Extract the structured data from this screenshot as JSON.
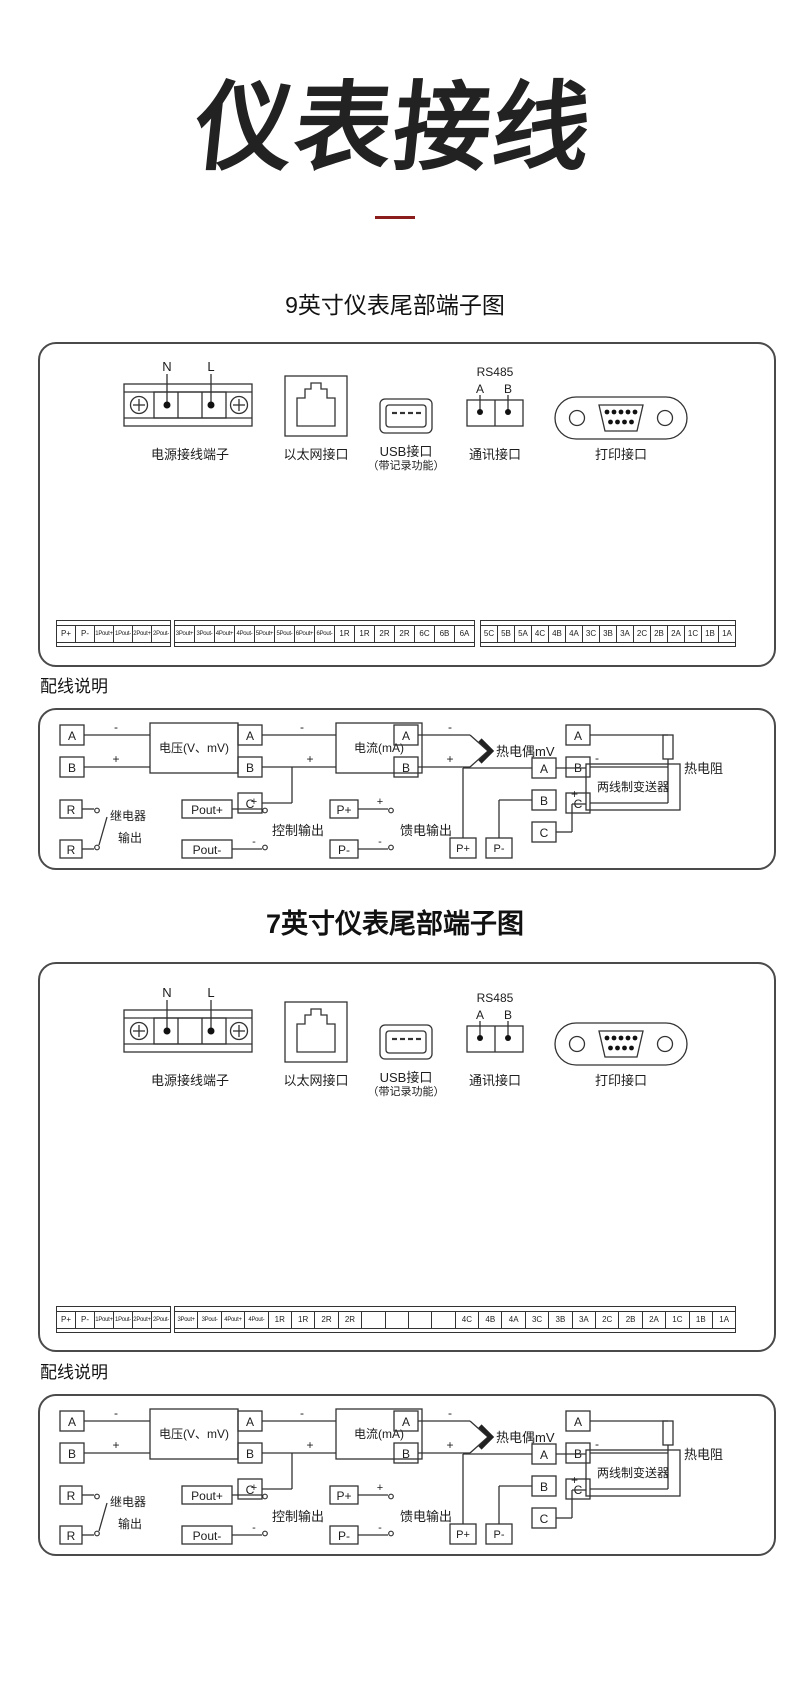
{
  "page": {
    "title": "仪表接线"
  },
  "colors": {
    "line": "#333333",
    "divider": "#8b1d1d",
    "panel_border": "#4a4a4a"
  },
  "shared": {
    "wiring_heading": "配线说明",
    "connectors": {
      "power": {
        "label": "电源接线端子",
        "pin_n": "N",
        "pin_l": "L"
      },
      "ethernet": {
        "label": "以太网接口"
      },
      "usb": {
        "label": "USB接口",
        "sublabel": "（带记录功能）"
      },
      "rs485": {
        "title": "RS485",
        "pin_a": "A",
        "pin_b": "B",
        "label": "通讯接口"
      },
      "printer": {
        "label": "打印接口"
      }
    },
    "wiring": {
      "voltage": {
        "t1": "A",
        "t2": "B",
        "neg": "-",
        "pos": "+",
        "label": "电压(V、mV)"
      },
      "current": {
        "t1": "A",
        "t2": "B",
        "t3": "C",
        "neg": "-",
        "pos": "+",
        "label": "电流(mA)"
      },
      "thermocouple": {
        "t1": "A",
        "t2": "B",
        "neg": "-",
        "pos": "+",
        "label": "热电偶mV"
      },
      "rtd": {
        "t1": "A",
        "t2": "B",
        "t3": "C",
        "label": "热电阻"
      },
      "relay": {
        "t1": "R",
        "t2": "R",
        "label1": "继电器",
        "label2": "输出"
      },
      "control": {
        "t1": "Pout+",
        "t2": "Pout-",
        "pos": "+",
        "neg": "-",
        "label": "控制输出"
      },
      "feed": {
        "t1": "P+",
        "t2": "P-",
        "pos": "+",
        "neg": "-",
        "label": "馈电输出"
      },
      "transmitter": {
        "t1": "A",
        "t2": "B",
        "t3": "C",
        "b1": "P+",
        "b2": "P-",
        "neg": "-",
        "pos": "+",
        "label": "两线制变送器"
      }
    }
  },
  "sections": [
    {
      "heading": "9英寸仪表尾部端子图",
      "strip_groups": {
        "g1": [
          "P+",
          "P-",
          "1Pout+",
          "1Pout-",
          "2Pout+",
          "2Pout-"
        ],
        "g2": [
          "3Pout+",
          "3Pout-",
          "4Pout+",
          "4Pout-",
          "5Pout+",
          "5Pout-",
          "6Pout+",
          "6Pout-",
          "1R",
          "1R",
          "2R",
          "2R",
          "6C",
          "6B",
          "6A"
        ],
        "g3": [
          "5C",
          "5B",
          "5A",
          "4C",
          "4B",
          "4A",
          "3C",
          "3B",
          "3A",
          "2C",
          "2B",
          "2A",
          "1C",
          "1B",
          "1A"
        ]
      }
    },
    {
      "heading": "7英寸仪表尾部端子图",
      "strip_groups": {
        "g1": [
          "P+",
          "P-",
          "1Pout+",
          "1Pout-",
          "2Pout+",
          "2Pout-"
        ],
        "g2": [
          "3Pout+",
          "3Pout-",
          "4Pout+",
          "4Pout-",
          "1R",
          "1R",
          "2R",
          "2R",
          "",
          "",
          "",
          "",
          "4C",
          "4B",
          "4A",
          "3C",
          "3B",
          "3A",
          "2C",
          "2B",
          "2A",
          "1C",
          "1B",
          "1A"
        ]
      }
    }
  ]
}
